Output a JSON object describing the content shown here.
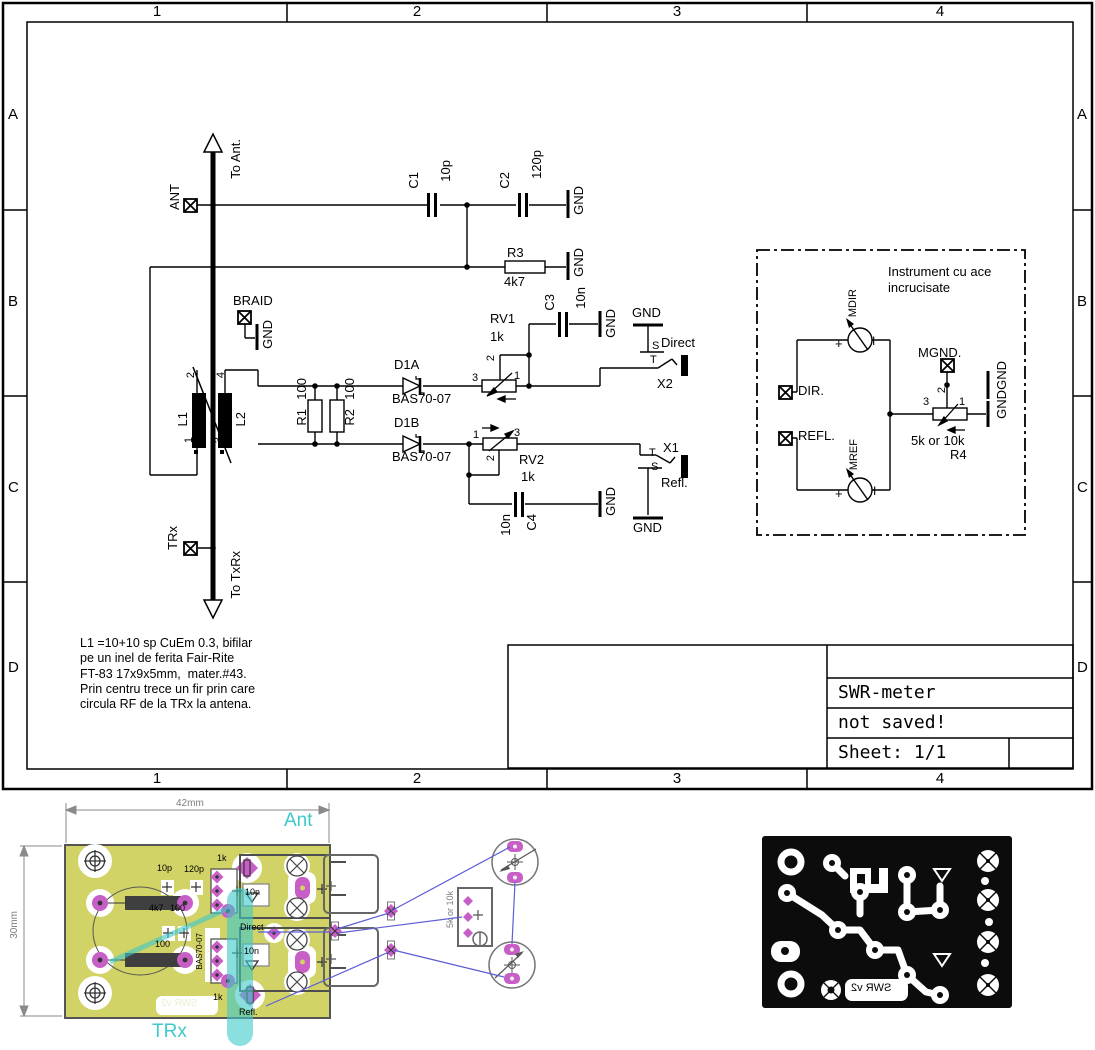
{
  "sheet": {
    "columns": [
      "1",
      "2",
      "3",
      "4"
    ],
    "rows": [
      "A",
      "B",
      "C",
      "D"
    ]
  },
  "title_block": {
    "title": "SWR-meter",
    "status": "not saved!",
    "sheet": "Sheet: 1/1"
  },
  "note_lines": [
    "L1 =10+10 sp CuEm 0.3, bifilar",
    "pe un inel de ferita Fair-Rite",
    "FT-83 17x9x5mm,  mater.#43.",
    "Prin centru trece un fir prin care",
    "circula RF de la TRx la antena."
  ],
  "colors": {
    "board_copper": "#d2d366",
    "pad_magenta": "#c75fc7",
    "net_highlight_cyan": "#3ec9c9",
    "airwire_blue": "#5d5dd5",
    "artwork_black": "#0c0c0c"
  },
  "schematic_labels": [
    {
      "id": "ant-pin-label",
      "t": "ANT",
      "x": 168,
      "y": 184,
      "v": 1
    },
    {
      "id": "to-ant-label",
      "t": "To Ant.",
      "x": 229,
      "y": 139,
      "v": 1
    },
    {
      "id": "c1-ref",
      "t": "C1",
      "x": 407,
      "y": 172,
      "v": 1
    },
    {
      "id": "c1-value",
      "t": "10p",
      "x": 439,
      "y": 160,
      "v": 1
    },
    {
      "id": "c2-ref",
      "t": "C2",
      "x": 498,
      "y": 172,
      "v": 1
    },
    {
      "id": "c2-value",
      "t": "120p",
      "x": 530,
      "y": 150,
      "v": 1
    },
    {
      "id": "gnd-c2",
      "t": "GND",
      "x": 572,
      "y": 186,
      "v": 1
    },
    {
      "id": "r3-ref",
      "t": "R3",
      "x": 507,
      "y": 246
    },
    {
      "id": "r3-value",
      "t": "4k7",
      "x": 504,
      "y": 275
    },
    {
      "id": "gnd-r3",
      "t": "GND",
      "x": 572,
      "y": 248,
      "v": 1
    },
    {
      "id": "braid-pin-label",
      "t": "BRAID",
      "x": 233,
      "y": 294
    },
    {
      "id": "gnd-braid",
      "t": "GND",
      "x": 261,
      "y": 320,
      "v": 1
    },
    {
      "id": "l1-pin2",
      "t": "2",
      "x": 186,
      "y": 372,
      "v": 1,
      "s": 11
    },
    {
      "id": "l1-pin4",
      "t": "4",
      "x": 216,
      "y": 372,
      "v": 1,
      "s": 11
    },
    {
      "id": "l1-ref",
      "t": "L1",
      "x": 176,
      "y": 412,
      "v": 1
    },
    {
      "id": "l2-ref",
      "t": "L2",
      "x": 234,
      "y": 412,
      "v": 1
    },
    {
      "id": "l1-pin1",
      "t": "1",
      "x": 184,
      "y": 437,
      "v": 1,
      "s": 11
    },
    {
      "id": "l1-pin3",
      "t": "3",
      "x": 214,
      "y": 437,
      "v": 1,
      "s": 11
    },
    {
      "id": "r1-value",
      "t": "100",
      "x": 295,
      "y": 378,
      "v": 1
    },
    {
      "id": "r1-ref",
      "t": "R1",
      "x": 295,
      "y": 409,
      "v": 1
    },
    {
      "id": "r2-value",
      "t": "100",
      "x": 343,
      "y": 378,
      "v": 1
    },
    {
      "id": "r2-ref",
      "t": "R2",
      "x": 343,
      "y": 409,
      "v": 1
    },
    {
      "id": "d1a-ref",
      "t": "D1A",
      "x": 394,
      "y": 358
    },
    {
      "id": "d1a-value",
      "t": "BAS70-07",
      "x": 392,
      "y": 392
    },
    {
      "id": "d1b-ref",
      "t": "D1B",
      "x": 394,
      "y": 416
    },
    {
      "id": "d1b-value",
      "t": "BAS70-07",
      "x": 392,
      "y": 450
    },
    {
      "id": "rv1-ref",
      "t": "RV1",
      "x": 490,
      "y": 312
    },
    {
      "id": "rv1-value",
      "t": "1k",
      "x": 490,
      "y": 330
    },
    {
      "id": "rv1-pin3",
      "t": "3",
      "x": 472,
      "y": 373,
      "s": 11
    },
    {
      "id": "rv1-pin1",
      "t": "1",
      "x": 514,
      "y": 371,
      "s": 11
    },
    {
      "id": "rv1-pin2",
      "t": "2",
      "x": 486,
      "y": 355,
      "v": 1,
      "s": 11
    },
    {
      "id": "c3-ref",
      "t": "C3",
      "x": 543,
      "y": 294,
      "v": 1
    },
    {
      "id": "c3-value",
      "t": "10n",
      "x": 574,
      "y": 287,
      "v": 1
    },
    {
      "id": "gnd-c3",
      "t": "GND",
      "x": 604,
      "y": 309,
      "v": 1
    },
    {
      "id": "gnd-x2",
      "t": "GND",
      "x": 632,
      "y": 306
    },
    {
      "id": "x2-s",
      "t": "S",
      "x": 652,
      "y": 341,
      "s": 11
    },
    {
      "id": "x2-net",
      "t": "Direct",
      "x": 661,
      "y": 336
    },
    {
      "id": "x2-t",
      "t": "T",
      "x": 650,
      "y": 355,
      "s": 11
    },
    {
      "id": "x2-ref",
      "t": "X2",
      "x": 657,
      "y": 377
    },
    {
      "id": "rv2-pin1",
      "t": "1",
      "x": 473,
      "y": 430,
      "s": 11
    },
    {
      "id": "rv2-pin3",
      "t": "3",
      "x": 514,
      "y": 428,
      "s": 11
    },
    {
      "id": "rv2-pin2",
      "t": "2",
      "x": 486,
      "y": 455,
      "v": 1,
      "s": 11
    },
    {
      "id": "rv2-ref",
      "t": "RV2",
      "x": 519,
      "y": 453
    },
    {
      "id": "rv2-value",
      "t": "1k",
      "x": 521,
      "y": 470
    },
    {
      "id": "c4-value",
      "t": "10n",
      "x": 499,
      "y": 514,
      "v": 1
    },
    {
      "id": "c4-ref",
      "t": "C4",
      "x": 525,
      "y": 514,
      "v": 1
    },
    {
      "id": "gnd-c4",
      "t": "GND",
      "x": 604,
      "y": 487,
      "v": 1
    },
    {
      "id": "x1-t",
      "t": "T",
      "x": 649,
      "y": 448,
      "s": 11
    },
    {
      "id": "x1-ref",
      "t": "X1",
      "x": 663,
      "y": 441
    },
    {
      "id": "x1-s",
      "t": "S",
      "x": 651,
      "y": 462,
      "s": 11
    },
    {
      "id": "x1-net",
      "t": "Refl.",
      "x": 661,
      "y": 476
    },
    {
      "id": "gnd-x1",
      "t": "GND",
      "x": 633,
      "y": 521
    },
    {
      "id": "trx-pin-label",
      "t": "TRx",
      "x": 166,
      "y": 526,
      "v": 1
    },
    {
      "id": "to-txrx-label",
      "t": "To TxRx",
      "x": 229,
      "y": 551,
      "v": 1
    },
    {
      "id": "instrument-note-1",
      "t": "Instrument cu ace",
      "x": 888,
      "y": 265
    },
    {
      "id": "instrument-note-2",
      "t": "incrucisate",
      "x": 888,
      "y": 281
    },
    {
      "id": "mdir-label",
      "t": "MDIR",
      "x": 848,
      "y": 289,
      "v": 1,
      "s": 11
    },
    {
      "id": "mdir-plus",
      "t": "+",
      "x": 835,
      "y": 337
    },
    {
      "id": "mdir-i",
      "t": "I",
      "x": 872,
      "y": 335,
      "s": 12
    },
    {
      "id": "dir-pin-label",
      "t": "DIR.",
      "x": 798,
      "y": 384
    },
    {
      "id": "refl-pin-label",
      "t": "REFL.",
      "x": 798,
      "y": 429
    },
    {
      "id": "mref-label",
      "t": "MREF",
      "x": 849,
      "y": 439,
      "v": 1,
      "s": 11
    },
    {
      "id": "mref-plus",
      "t": "+",
      "x": 835,
      "y": 487
    },
    {
      "id": "mref-i",
      "t": "I",
      "x": 873,
      "y": 485,
      "s": 12
    },
    {
      "id": "mgnd-pin-label",
      "t": "MGND.",
      "x": 918,
      "y": 346
    },
    {
      "id": "gnd-mgnd-1",
      "t": "GND",
      "x": 995,
      "y": 361,
      "v": 1
    },
    {
      "id": "gnd-mgnd-2",
      "t": "GND",
      "x": 995,
      "y": 390,
      "v": 1
    },
    {
      "id": "r4-pin3",
      "t": "3",
      "x": 923,
      "y": 397,
      "s": 11
    },
    {
      "id": "r4-pin1",
      "t": "1",
      "x": 959,
      "y": 397,
      "s": 11
    },
    {
      "id": "r4-pin2",
      "t": "2",
      "x": 937,
      "y": 387,
      "v": 1,
      "s": 11
    },
    {
      "id": "r4-value",
      "t": "5k or 10k",
      "x": 911,
      "y": 434
    },
    {
      "id": "r4-ref",
      "t": "R4",
      "x": 950,
      "y": 448
    }
  ],
  "board_labels": [
    {
      "id": "dim-width-label",
      "t": "42mm",
      "x": 176,
      "y": 799,
      "s": 10,
      "cls": "gray"
    },
    {
      "id": "dim-height-label",
      "t": "30mm",
      "x": 10,
      "y": 911,
      "s": 10,
      "cls": "gray",
      "v": 1
    },
    {
      "id": "board-net-ant",
      "t": "Ant",
      "x": 284,
      "y": 811,
      "cls": "cyan"
    },
    {
      "id": "board-net-trx",
      "t": "TRx",
      "x": 152,
      "y": 1022,
      "cls": "cyan"
    },
    {
      "id": "board-c1-value",
      "t": "10p",
      "x": 157,
      "y": 864,
      "s": 9
    },
    {
      "id": "board-c2-value",
      "t": "120p",
      "x": 184,
      "y": 865,
      "s": 9
    },
    {
      "id": "board-rv1-value",
      "t": "1k",
      "x": 217,
      "y": 854,
      "s": 9
    },
    {
      "id": "board-c3-value",
      "t": "10n",
      "x": 245,
      "y": 888,
      "s": 9
    },
    {
      "id": "board-r3-value",
      "t": "4k7",
      "x": 149,
      "y": 904,
      "s": 9
    },
    {
      "id": "board-r1-value",
      "t": "100",
      "x": 170,
      "y": 904,
      "s": 9
    },
    {
      "id": "board-r2-value",
      "t": "100",
      "x": 155,
      "y": 940,
      "s": 9
    },
    {
      "id": "board-d1-value",
      "t": "BAS70-07",
      "x": 196,
      "y": 933,
      "s": 8,
      "v": 1
    },
    {
      "id": "board-c4-value",
      "t": "10n",
      "x": 244,
      "y": 947,
      "s": 9
    },
    {
      "id": "board-rv2-value",
      "t": "1k",
      "x": 213,
      "y": 993,
      "s": 9
    },
    {
      "id": "board-net-direct",
      "t": "Direct",
      "x": 240,
      "y": 923,
      "s": 9
    },
    {
      "id": "board-net-refl",
      "t": "Refl.",
      "x": 239,
      "y": 1008,
      "s": 9
    },
    {
      "id": "board-silk-swr",
      "t": "SWR v2",
      "x": 161,
      "y": 999,
      "s": 10,
      "cls": "mir silkw"
    },
    {
      "id": "offboard-r4-value",
      "t": "5k or 10k",
      "x": 446,
      "y": 891,
      "s": 9,
      "cls": "gray",
      "v": 1
    },
    {
      "id": "artwork-silk-swr",
      "t": "SWR v2",
      "x": 851,
      "y": 983,
      "s": 11,
      "cls": "mir"
    }
  ]
}
